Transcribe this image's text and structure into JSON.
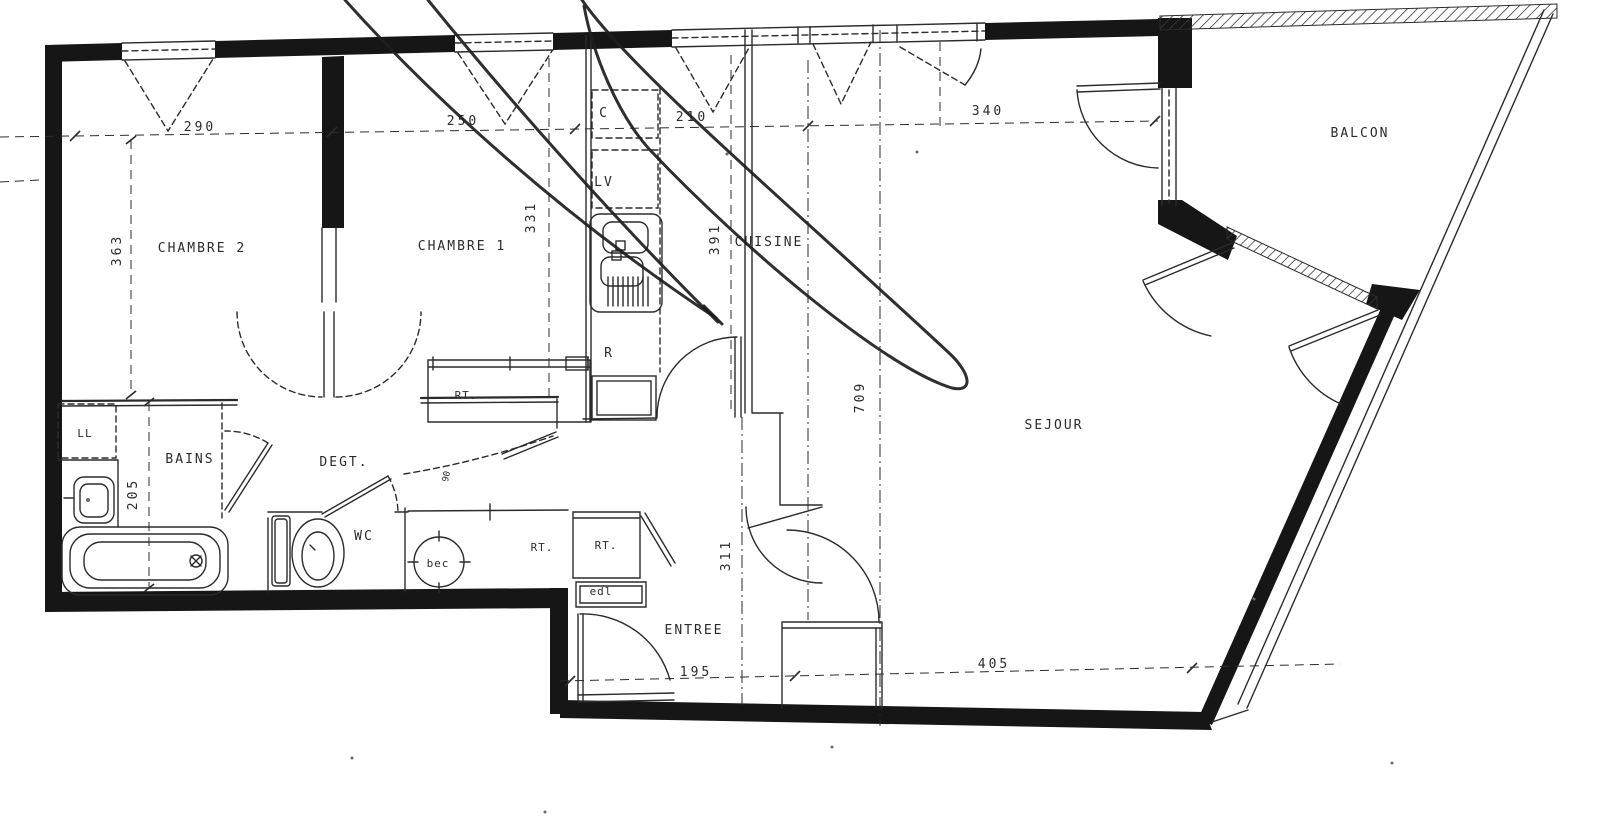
{
  "rooms": {
    "chambre2": "CHAMBRE 2",
    "chambre1": "CHAMBRE 1",
    "cuisine": "CUISINE",
    "sejour": "SEJOUR",
    "balcon": "BALCON",
    "bains": "BAINS",
    "degagement": "DEGT.",
    "wc": "WC",
    "entree": "ENTREE"
  },
  "closets": {
    "rt_chambre1": "RT.",
    "rt_couloir": "RT.",
    "rt_entree": "RT.",
    "edl": "edl"
  },
  "equipment": {
    "lave_linge": "LL",
    "cuisson": "C",
    "lave_vaisselle": "LV",
    "refrigerateur": "R",
    "ballon_eau_chaude": "bec",
    "porte_largeur": "90"
  },
  "dimensions_cm": {
    "h_290": "290",
    "h_250": "250",
    "h_210": "210",
    "h_340": "340",
    "h_195": "195",
    "h_405": "405",
    "v_363": "363",
    "v_331": "331",
    "v_391": "391",
    "v_709": "709",
    "v_205": "205",
    "v_311": "311"
  },
  "colors": {
    "ink": "#2b2b2b",
    "wall": "#161616",
    "paper": "#ffffff"
  }
}
